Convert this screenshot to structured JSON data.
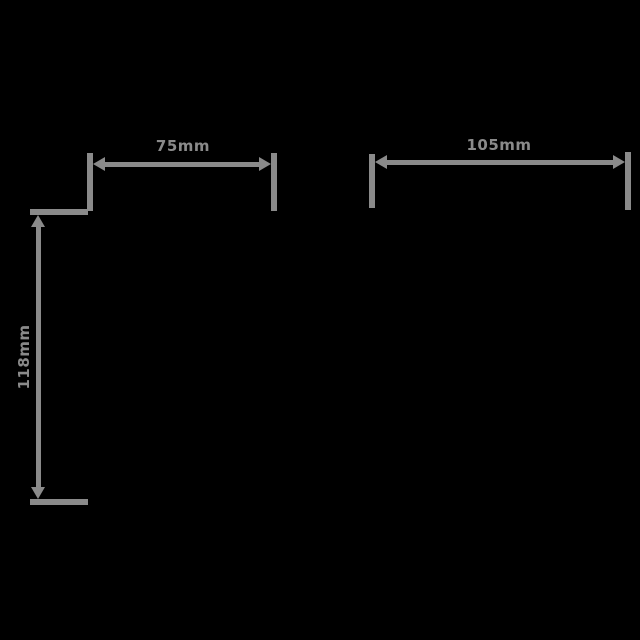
{
  "page": {
    "background_color": "#000000"
  },
  "drawing": {
    "type": "dimension-diagram",
    "line_color": "#8a8a8a",
    "text_color": "#8a8a8a",
    "dimensions": [
      {
        "id": "top-left-width",
        "label": "75mm",
        "orientation": "horizontal"
      },
      {
        "id": "top-right-width",
        "label": "105mm",
        "orientation": "horizontal"
      },
      {
        "id": "left-height",
        "label": "118mm",
        "orientation": "vertical"
      }
    ]
  }
}
